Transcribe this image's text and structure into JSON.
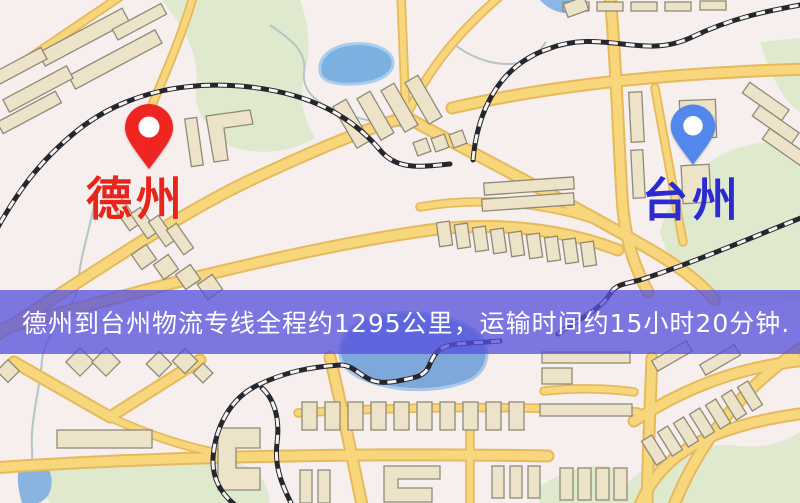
{
  "map": {
    "origin": {
      "name": "德州",
      "pin_color": "#ee2520",
      "label_color": "#e8251d"
    },
    "destination": {
      "name": "台州",
      "pin_color": "#5288ec",
      "label_color": "#2b2bd0"
    },
    "palette": {
      "background": "#f6efed",
      "road": "#f8d77c",
      "road_casing": "#e6b95c",
      "railway": "#26262e",
      "water": "#7cb0e0",
      "green_space": "#dfe9cd",
      "building": "#ece3c8"
    }
  },
  "banner": {
    "text": "德州到台州物流专线全程约1295公里，运输时间约15小时20分钟.",
    "background_color": "rgba(86,80,221,0.76)",
    "text_color": "#ffffff",
    "route": {
      "origin": "德州",
      "destination": "台州",
      "service": "物流专线",
      "distance": "约1295公里",
      "duration": "约15小时20分钟"
    }
  }
}
